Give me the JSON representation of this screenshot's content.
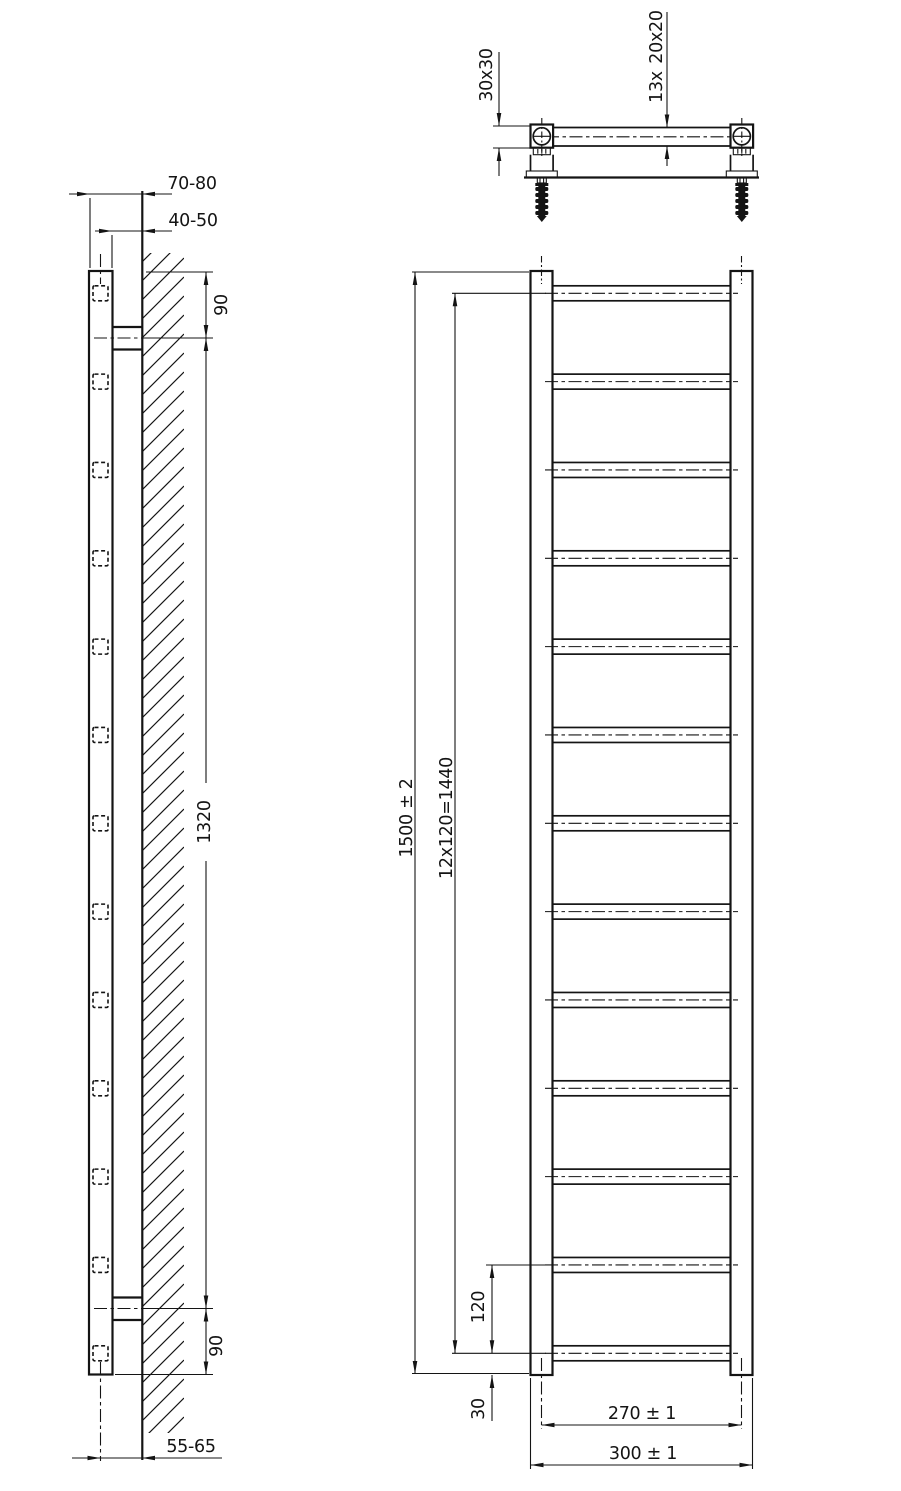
{
  "drawing": {
    "side_view": {
      "dim_wall_to_front": "70-80",
      "dim_wall_gap": "40-50",
      "dim_top_bracket": "90",
      "dim_bracket_span": "1320",
      "dim_bottom_bracket": "90",
      "dim_wall_to_axis": "55-65"
    },
    "top_view": {
      "dim_profile": "30x30",
      "dim_rung_count": "13x",
      "dim_rung_profile": "20x20"
    },
    "front_view": {
      "dim_height": "1500 ± 2",
      "dim_pitch_total": "12x120=1440",
      "dim_pitch": "120",
      "dim_bottom": "30",
      "dim_axis_width": "270 ± 1",
      "dim_width": "300 ± 1"
    }
  }
}
